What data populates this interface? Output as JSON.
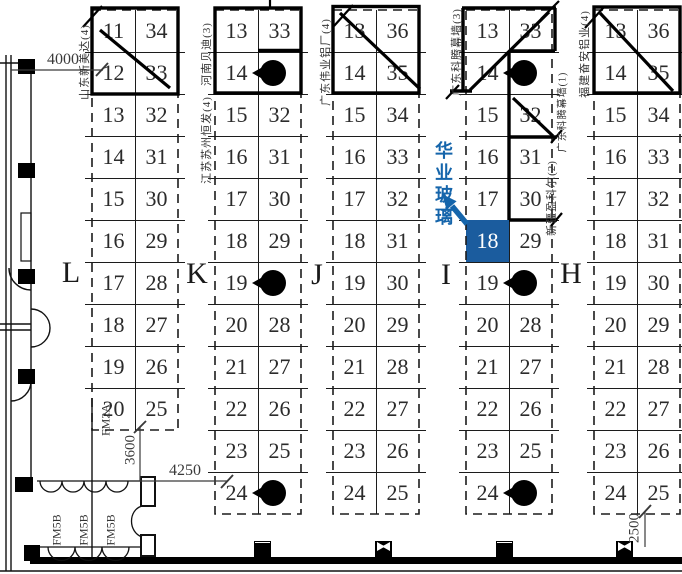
{
  "columns": [
    {
      "label": "L",
      "booths": [
        {
          "left": "11",
          "right": "34"
        },
        {
          "left": "12",
          "right": "33"
        },
        {
          "left": "13",
          "right": "32"
        },
        {
          "left": "14",
          "right": "31"
        },
        {
          "left": "15",
          "right": "30"
        },
        {
          "left": "16",
          "right": "29"
        },
        {
          "left": "17",
          "right": "28"
        },
        {
          "left": "18",
          "right": "27"
        },
        {
          "left": "19",
          "right": "26"
        },
        {
          "left": "20",
          "right": "25"
        }
      ]
    },
    {
      "label": "K",
      "booths": [
        {
          "left": "13",
          "right": "33"
        },
        {
          "left": "14",
          "pillar": true
        },
        {
          "left": "15",
          "right": "32"
        },
        {
          "left": "16",
          "right": "31"
        },
        {
          "left": "17",
          "right": "30"
        },
        {
          "left": "18",
          "right": "29"
        },
        {
          "left": "19",
          "pillar": true
        },
        {
          "left": "20",
          "right": "28"
        },
        {
          "left": "21",
          "right": "27"
        },
        {
          "left": "22",
          "right": "26"
        },
        {
          "left": "23",
          "right": "25"
        },
        {
          "left": "24",
          "pillar": true
        }
      ]
    },
    {
      "label": "J",
      "booths": [
        {
          "left": "13",
          "right": "36"
        },
        {
          "left": "14",
          "right": "35"
        },
        {
          "left": "15",
          "right": "34"
        },
        {
          "left": "16",
          "right": "33"
        },
        {
          "left": "17",
          "right": "32"
        },
        {
          "left": "18",
          "right": "31"
        },
        {
          "left": "19",
          "right": "30"
        },
        {
          "left": "20",
          "right": "29"
        },
        {
          "left": "21",
          "right": "28"
        },
        {
          "left": "22",
          "right": "27"
        },
        {
          "left": "23",
          "right": "26"
        },
        {
          "left": "24",
          "right": "25"
        }
      ]
    },
    {
      "label": "I",
      "booths": [
        {
          "left": "13",
          "right": "33"
        },
        {
          "left": "14",
          "pillar": true
        },
        {
          "left": "15",
          "right": "32"
        },
        {
          "left": "16",
          "right": "31"
        },
        {
          "left": "17",
          "right": "30"
        },
        {
          "left": "18",
          "right": "29",
          "highlight": true
        },
        {
          "left": "19",
          "pillar": true
        },
        {
          "left": "20",
          "right": "28"
        },
        {
          "left": "21",
          "right": "27"
        },
        {
          "left": "22",
          "right": "26"
        },
        {
          "left": "23",
          "right": "25"
        },
        {
          "left": "24",
          "pillar": true
        }
      ]
    },
    {
      "label": "H",
      "booths": [
        {
          "left": "13",
          "right": "36"
        },
        {
          "left": "14",
          "right": "35"
        },
        {
          "left": "15",
          "right": "34"
        },
        {
          "left": "16",
          "right": "33"
        },
        {
          "left": "17",
          "right": "32"
        },
        {
          "left": "18",
          "right": "31"
        },
        {
          "left": "19",
          "right": "30"
        },
        {
          "left": "20",
          "right": "29"
        },
        {
          "left": "21",
          "right": "28"
        },
        {
          "left": "22",
          "right": "27"
        },
        {
          "left": "23",
          "right": "26"
        },
        {
          "left": "24",
          "right": "25"
        }
      ]
    }
  ],
  "exhibitors": [
    {
      "text": "山东新美达(4)"
    },
    {
      "text": "河南贝迪(3)"
    },
    {
      "text": "江苏苏州恒发(4)"
    },
    {
      "text": "广东伟业铝厂(4)"
    },
    {
      "text": "广东科腾幕墙(3)"
    },
    {
      "text": "福建奋安铝业(4)"
    },
    {
      "text": "广东科腾幕墙(1)"
    },
    {
      "text": "新疆盈科尔(2)"
    }
  ],
  "callout": {
    "text": "华业玻璃",
    "booth": "18"
  },
  "dimensions": [
    {
      "value": "4000"
    },
    {
      "value": "3600"
    },
    {
      "value": "4250"
    },
    {
      "value": "2500"
    }
  ],
  "door_labels": [
    {
      "text": "FM2A"
    },
    {
      "text": "FM5B"
    },
    {
      "text": "FM5B"
    },
    {
      "text": "FM5B"
    }
  ],
  "colors": {
    "highlight_fill": "#1b5c9e",
    "callout_blue": "#1565ab",
    "line": "#1a1a1a"
  }
}
